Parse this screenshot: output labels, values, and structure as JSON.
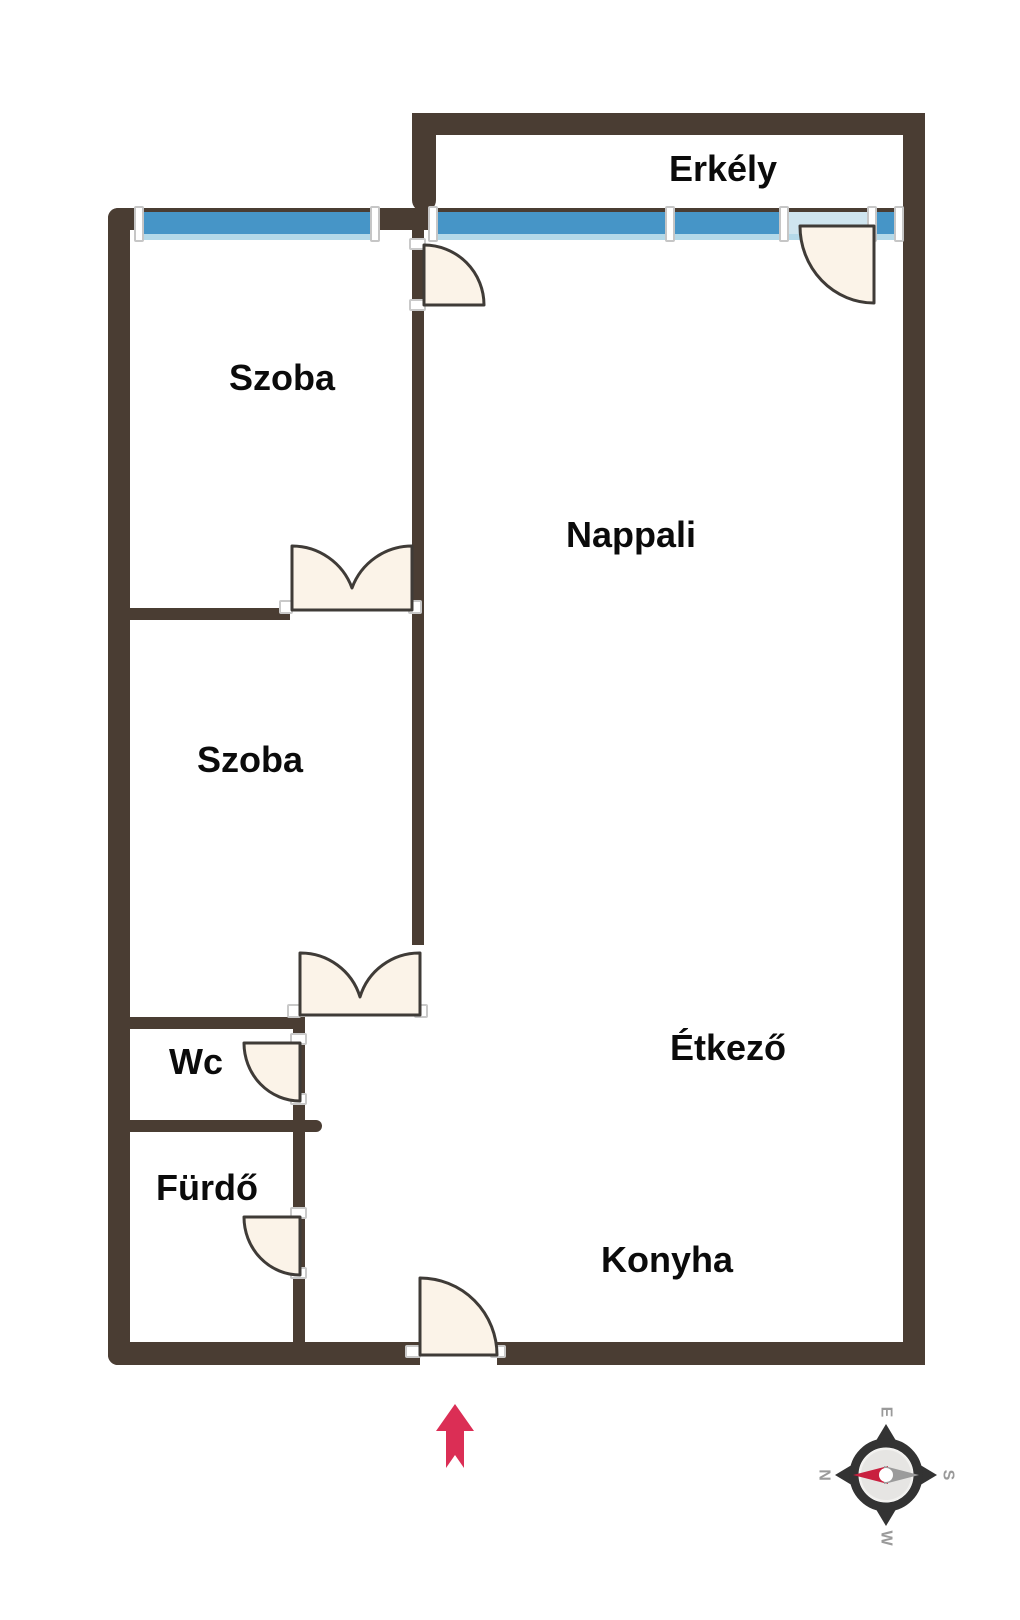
{
  "rooms": {
    "erkely": {
      "label": "Erkély"
    },
    "szoba1": {
      "label": "Szoba"
    },
    "nappali": {
      "label": "Nappali"
    },
    "szoba2": {
      "label": "Szoba"
    },
    "wc": {
      "label": "Wc"
    },
    "furdo": {
      "label": "Fürdő"
    },
    "etkezo": {
      "label": "Étkező"
    },
    "konyha": {
      "label": "Konyha"
    }
  },
  "compass": {
    "top": "E",
    "left": "N",
    "right": "S",
    "bottom": "W"
  },
  "colors": {
    "wall": "#4a3d33",
    "window_blue": "#4695c7",
    "window_pale": "#b4d9e9",
    "window_door_section": "#cfe5ef",
    "door_fill": "#fbf3e8",
    "door_stroke": "#3f3b37",
    "entrance_arrow": "#db2e55",
    "compass_ring": "#333333",
    "compass_needle_red": "#c9203f",
    "compass_needle_gray": "#9b9b9b",
    "label_text": "#0b0b0b"
  }
}
